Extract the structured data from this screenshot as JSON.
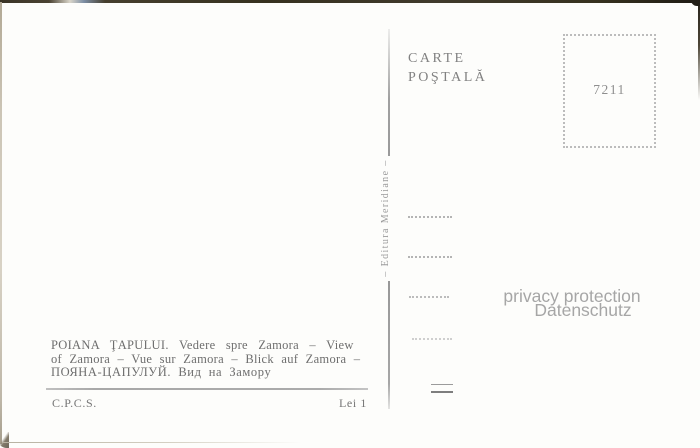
{
  "header": {
    "title_line1": "CARTE",
    "title_line2": "POŞTALĂ"
  },
  "stamp_box": {
    "number": "7211"
  },
  "spine": {
    "publisher": "– Editura Meridiane –"
  },
  "watermark": {
    "line1": "privacy protection",
    "line2": "Datenschutz"
  },
  "caption": {
    "line1": "POIANA ŢAPULUI. Vedere spre Zamora – View",
    "line2": "of Zamora – Vue sur Zamora – Blick auf Zamora –",
    "line3": "ПОЯНА-ЦАПУЛУЙ. Вид на Замору"
  },
  "footer": {
    "agency": "C.P.C.S.",
    "price": "Lei 1"
  },
  "colors": {
    "paper": "#fdfdfb",
    "print_ink": "#818181",
    "caption_ink": "#6e6e6e",
    "divider_gray": "#a4a4a4",
    "dotted_gray": "#b4b4b4",
    "watermark_gray": "#a6a6a6",
    "scan_edge_dark": "#3a3426",
    "scan_edge_light": "#c9c2b3"
  }
}
